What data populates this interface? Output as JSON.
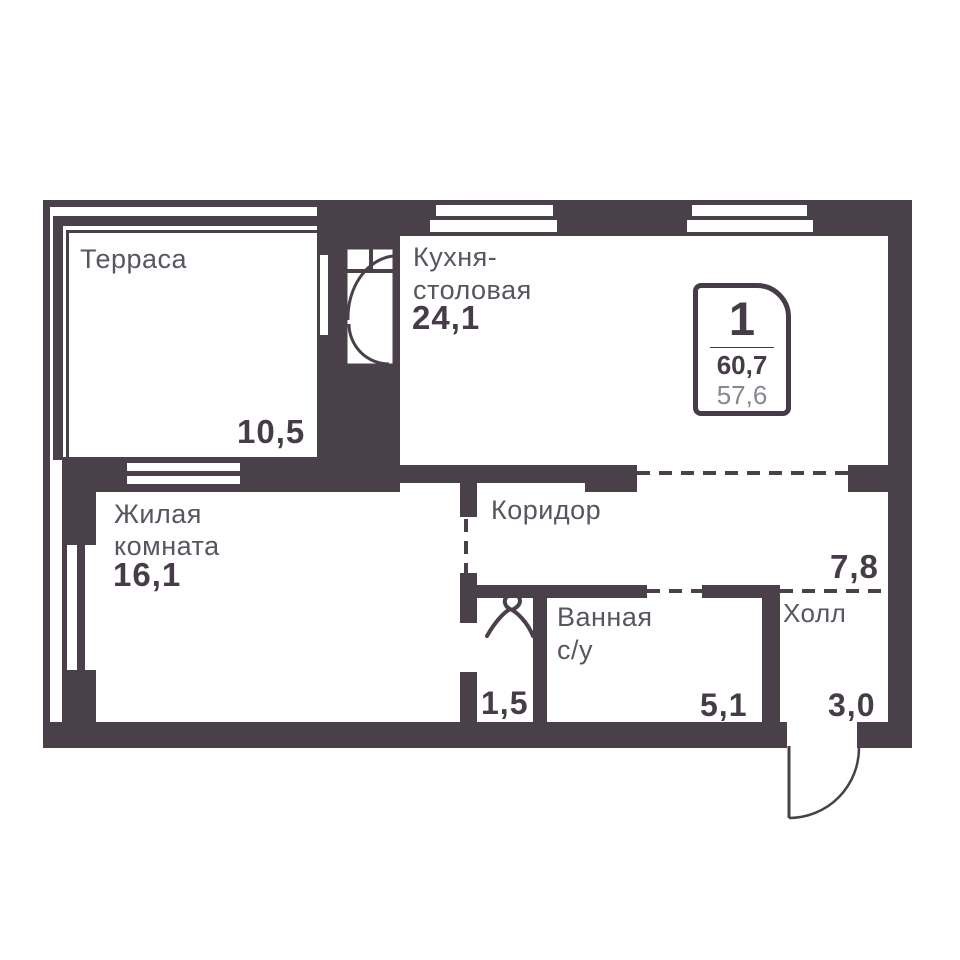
{
  "plan": {
    "badge": {
      "rooms_count": "1",
      "total_area": "60,7",
      "living_area": "57,6"
    },
    "rooms": {
      "terrace": {
        "name": "Терраса",
        "area": "10,5"
      },
      "kitchen": {
        "name_line1": "Кухня-",
        "name_line2": "столовая",
        "area": "24,1"
      },
      "living": {
        "name_line1": "Жилая",
        "name_line2": "комната",
        "area": "16,1"
      },
      "corridor": {
        "name": "Коридор"
      },
      "hall": {
        "name": "Холл",
        "area": "7,8"
      },
      "entry": {
        "area": "3,0"
      },
      "bathroom": {
        "name_line1": "Ванная",
        "name_line2": "с/у",
        "area": "5,1"
      },
      "wardrobe": {
        "area": "1,5"
      }
    },
    "icons": {
      "entrance_door": "door-swing-arc",
      "wardrobe": "coat-hanger",
      "terrace_kitchen_door": "glazed-door-with-swing",
      "windows": "double-slot-window"
    },
    "colors": {
      "wall": "#4a4049",
      "room_label": "#5a5460",
      "area_number": "#453c47",
      "secondary_number": "#8a8690",
      "background": "#ffffff"
    }
  }
}
